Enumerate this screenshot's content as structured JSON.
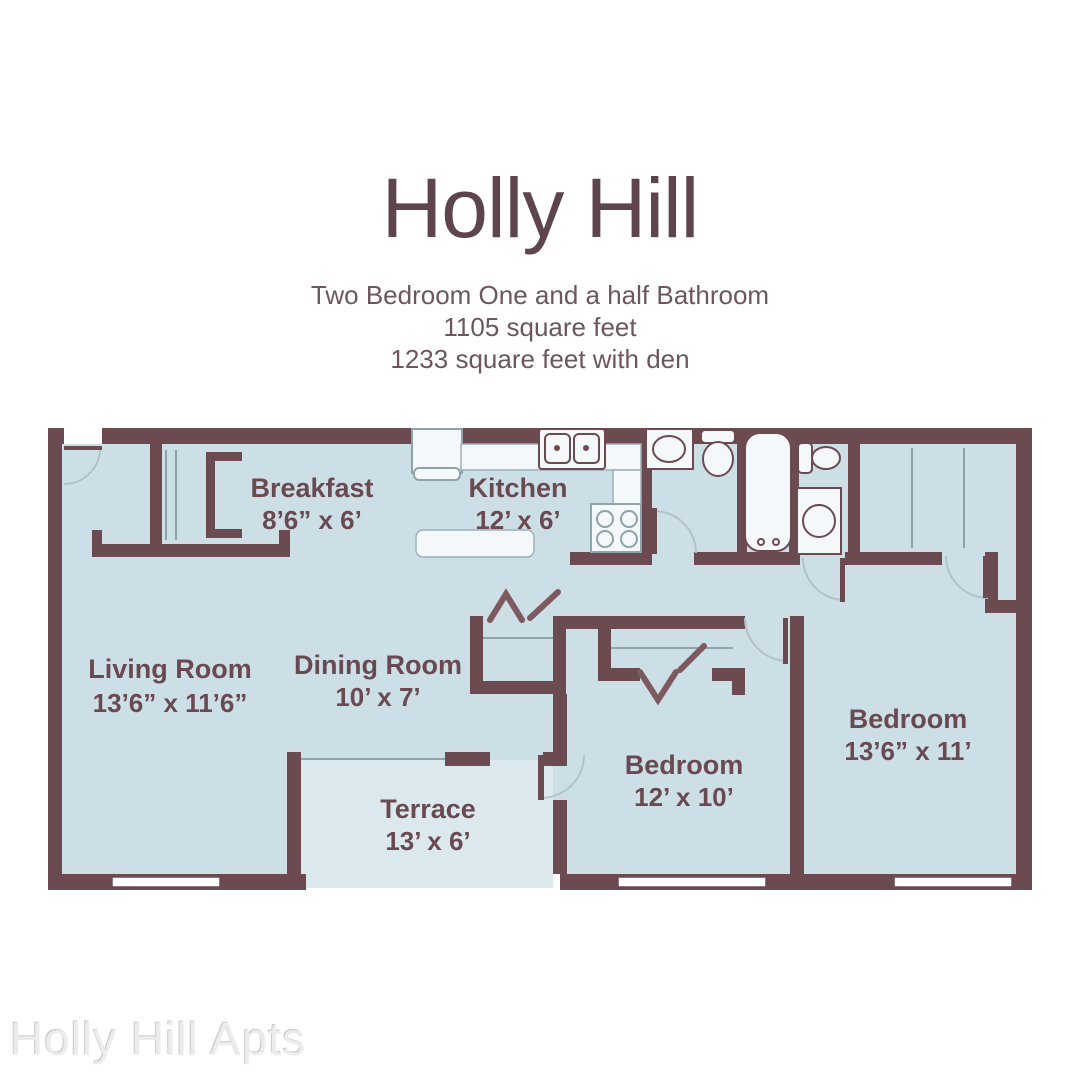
{
  "header": {
    "title": "Holly Hill",
    "subtitle_lines": [
      "Two Bedroom One and a half Bathroom",
      "1105 square feet",
      "1233 square feet with den"
    ]
  },
  "floorplan": {
    "rooms": [
      {
        "name": "Breakfast",
        "dims": "8’6” x 6’"
      },
      {
        "name": "Kitchen",
        "dims": "12’ x 6’"
      },
      {
        "name": "Living Room",
        "dims": "13’6” x 11’6”"
      },
      {
        "name": "Dining Room",
        "dims": "10’ x 7’"
      },
      {
        "name": "Terrace",
        "dims": "13’ x 6’"
      },
      {
        "name": "Bedroom",
        "dims": "12’ x 10’"
      },
      {
        "name": "Bedroom",
        "dims": "13’6” x 11’"
      }
    ],
    "fixtures": [
      "refrigerator",
      "kitchen-double-sink",
      "stove",
      "kitchen-island",
      "bathroom-sink",
      "toilet",
      "bathtub",
      "toilet",
      "washer",
      "closet-doors",
      "bifold-doors",
      "windows",
      "door-swings"
    ],
    "colors": {
      "wall": "#6b4a50",
      "room_fill": "#cddfe6",
      "terrace_fill": "#dbe9ee",
      "fixture_fill": "#f4f8fa",
      "door_arc": "#b3c2c9",
      "label_text": "#6a4a50",
      "title_text": "#5d454b"
    }
  },
  "footer": {
    "watermark": "Holly Hill Apts"
  }
}
